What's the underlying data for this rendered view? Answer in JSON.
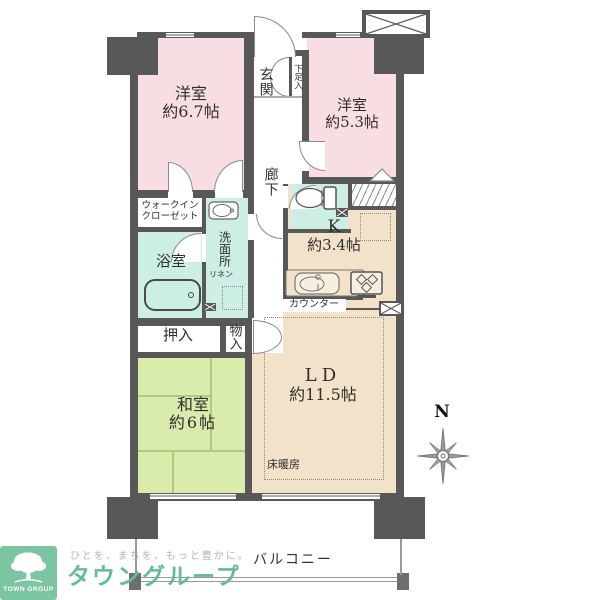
{
  "plan": {
    "room1": {
      "name": "洋室",
      "size": "約6.7帖"
    },
    "room2": {
      "name": "洋室",
      "size": "約5.3帖"
    },
    "entrance": "玄関",
    "shoe_box": "下足入",
    "corridor": "廊下",
    "wic_line1": "ウォークイン",
    "wic_line2": "クローゼット",
    "washroom": "洗面所",
    "bathroom": "浴室",
    "linen": "リネン",
    "kitchen": {
      "name": "K",
      "size": "約3.4帖"
    },
    "counter": "カウンター",
    "oshiire": "押入",
    "monoire": "物入",
    "washitsu": {
      "name": "和室",
      "size": "約6帖"
    },
    "ld": {
      "name": "LD",
      "size": "約11.5帖"
    },
    "floor_heating": "床暖房",
    "balcony": "バルコニー"
  },
  "compass": {
    "north": "N"
  },
  "branding": {
    "badge": "TOWN GROUP",
    "tagline": "ひとを、まちを、もっと豊かに。",
    "brand": "タウングループ"
  },
  "colors": {
    "wall": "#585858",
    "western_room_pink": "#f8dee3",
    "tatami_green": "#d9ecab",
    "living_beige": "#f1e2c9",
    "wet_area_mint": "#cdeee4",
    "logo_green": "#7cc5a3",
    "brand_text_green": "#63bd92",
    "tagline_gray": "#b3b3b3"
  }
}
